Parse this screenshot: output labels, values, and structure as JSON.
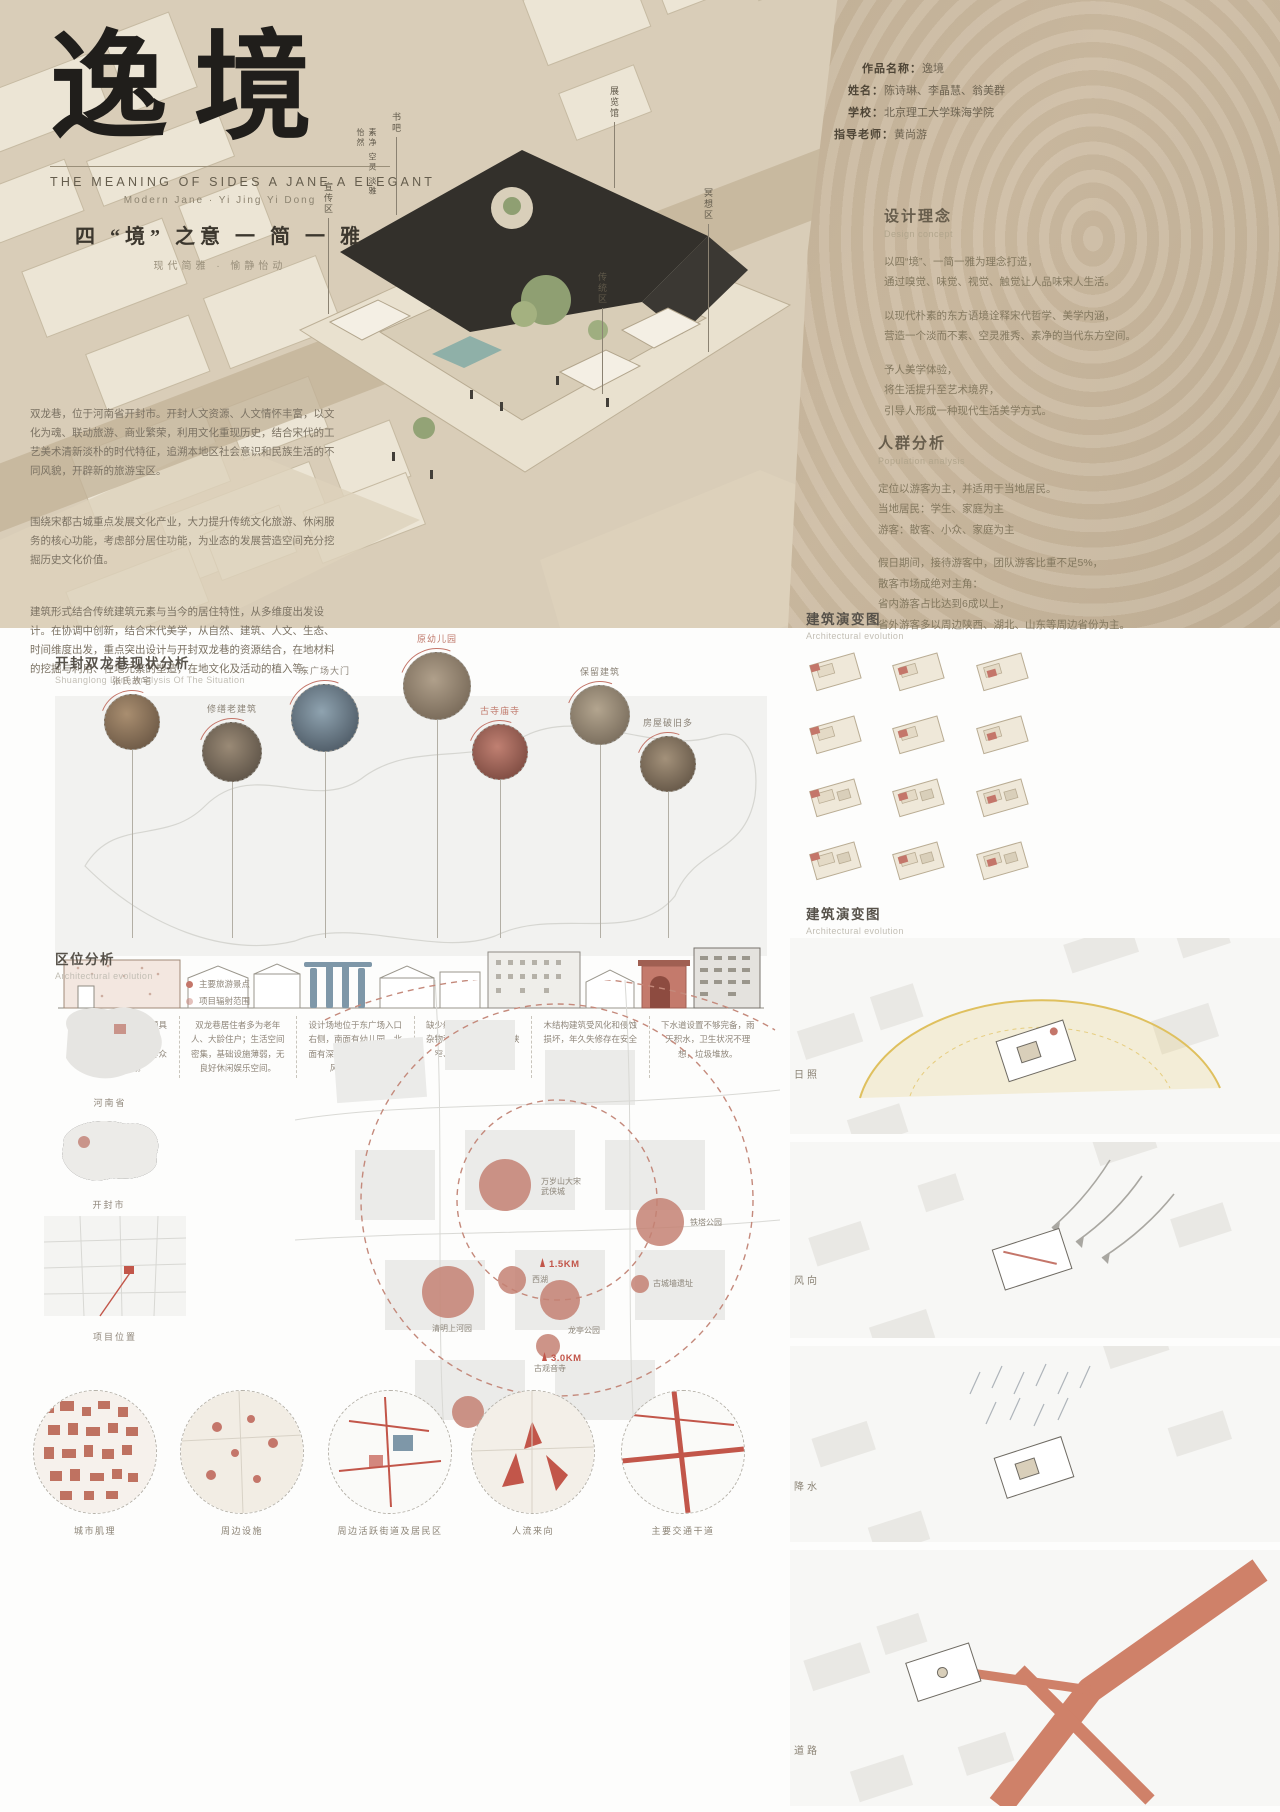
{
  "colors": {
    "accent_salmon": "#c4766a",
    "accent_red": "#c2564a",
    "beige": "#d9cdb8",
    "tan": "#c7b69d",
    "ink": "#201e1b"
  },
  "header": {
    "title": "逸境",
    "side_label": "素净 空灵 淡雅 怡然",
    "subtitle_en": "THE MEANING OF SIDES A JANE A ELEGANT",
    "subtitle_en2": "Modern Jane · Yi Jing Yi Dong",
    "tagline": "四 “境” 之意  一 简 一 雅",
    "tagline2": "现代简雅 · 愉静怡动"
  },
  "info": {
    "rows": [
      {
        "label": "作品名称：",
        "value": "逸境"
      },
      {
        "label": "姓名：",
        "value": "陈诗琳、李晶慧、翁美群"
      },
      {
        "label": "学校：",
        "value": "北京理工大学珠海学院"
      },
      {
        "label": "指导老师：",
        "value": "黄尚游"
      }
    ]
  },
  "concept": {
    "title": "设计理念",
    "subtitle": "Design concept",
    "paragraphs": [
      "以四“境”、一简一雅为理念打造，\n通过嗅觉、味觉、视觉、触觉让人品味宋人生活。",
      "以现代朴素的东方语境诠释宋代哲学、美学内涵，\n营造一个淡而不素、空灵雅秀、素净的当代东方空间。",
      "予人美学体验，\n将生活提升至艺术境界，\n引导人形成一种现代生活美学方式。"
    ]
  },
  "population": {
    "title": "人群分析",
    "subtitle": "Population analysis",
    "paragraphs": [
      "定位以游客为主，并适用于当地居民。\n当地居民：学生、家庭为主\n游客：散客、小众、家庭为主",
      "假日期间，接待游客中，团队游客比重不足5%，\n散客市场成绝对主角：\n省内游客占比达到6成以上，\n省外游客多以周边陕西、湖北、山东等周边省份为主。"
    ]
  },
  "intro": {
    "paragraphs": [
      "双龙巷，位于河南省开封市。开封人文资源、人文情怀丰富，以文化为魂、联动旅游、商业繁荣，利用文化重现历史，结合宋代的工艺美术清新淡朴的时代特征，追溯本地区社会意识和民族生活的不同风貌，开辟新的旅游宝区。",
      "围绕宋都古城重点发展文化产业，大力提升传统文化旅游、休闲服务的核心功能，考虑部分居住功能，为业态的发展营造空间充分挖掘历史文化价值。",
      "建筑形式结合传统建筑元素与当今的居住特性，从多维度出发设计。在协调中创新，结合宋代美学，从自然、建筑、人文、生态、时间维度出发，重点突出设计与开封双龙巷的资源结合，在地材料的挖掘与利用、在地元素的塑造，在地文化及活动的植入等。"
    ]
  },
  "callouts": [
    "书吧",
    "展览馆",
    "宣传区",
    "冥想区",
    "传统区"
  ],
  "situation": {
    "title": "开封双龙巷现状分析",
    "subtitle": "Shuanglong Lane Analysis Of The Situation",
    "spots": [
      {
        "label": "张氏故宅",
        "red": false
      },
      {
        "label": "修缮老建筑",
        "red": false
      },
      {
        "label": "东广场大门",
        "red": false
      },
      {
        "label": "原幼儿园",
        "red": true
      },
      {
        "label": "古寺庙寺",
        "red": true
      },
      {
        "label": "保留建筑",
        "red": false
      },
      {
        "label": "房屋破旧多",
        "red": false
      }
    ],
    "captions": [
      "由门大院，名人故居颇具特色，现存有张氏故宅、修缮德教堂、古寨府等众多历史建筑。",
      "双龙巷居住者多为老年人、大龄住户；生活空间密集，基础设施薄弱，无良好休闲娱乐空间。",
      "设计场地位于东广场入口右侧，南面有幼儿园，北面有深色建筑，新旧建筑风格不和谐。",
      "缺少绿化，巷内杂草多，杂物和堆砌杂乱，道路狭窄、车辆无法进入。",
      "木结构建筑受风化和侵蚀损坏，年久失修存在安全隐患。",
      "下水道设置不够完备，雨天积水，卫生状况不理想，垃圾堆放。"
    ]
  },
  "evolution": {
    "title": "建筑演变图",
    "subtitle": "Architectural evolution"
  },
  "evolution2": {
    "title": "建筑演变图",
    "subtitle": "Architectural evolution"
  },
  "env": {
    "labels": [
      "日照",
      "风向",
      "降水",
      "道路"
    ]
  },
  "location": {
    "title": "区位分析",
    "subtitle": "Architectural evolution",
    "legend": [
      "主要旅游景点",
      "项目辐射范围"
    ],
    "mini_maps": [
      "河南省",
      "开封市",
      "项目位置"
    ],
    "map_points": [
      {
        "name": "万岁山大宋\n武侠城"
      },
      {
        "name": "铁塔公园"
      },
      {
        "name": "西湖"
      },
      {
        "name": "清明上河园"
      },
      {
        "name": "龙亭公园"
      },
      {
        "name": "古城墙遗址"
      },
      {
        "name": "古观音寺"
      },
      {
        "name": "开封府"
      },
      {
        "name": "包公祠"
      }
    ],
    "radii": [
      "1.5KM",
      "3.0KM"
    ]
  },
  "bottom_circles": [
    "城市肌理",
    "周边设施",
    "周边活跃街道及居民区",
    "人流来向",
    "主要交通干道"
  ]
}
